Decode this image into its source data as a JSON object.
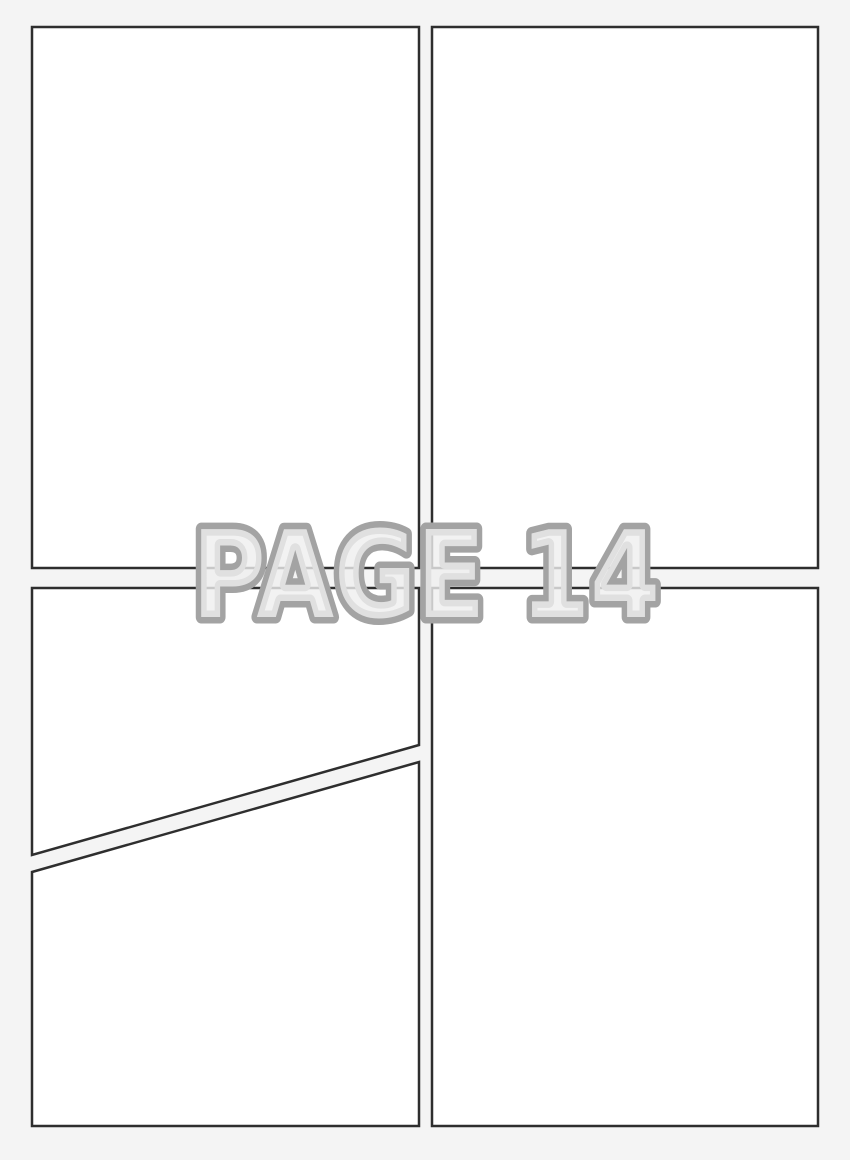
{
  "watermark": {
    "label": "PAGE 14"
  },
  "colors": {
    "background": "#f4f4f4",
    "panel_fill": "#ffffff",
    "panel_border": "#2e2e2e",
    "watermark_fill": "#efefef",
    "watermark_outline": "#a3a3a3"
  }
}
